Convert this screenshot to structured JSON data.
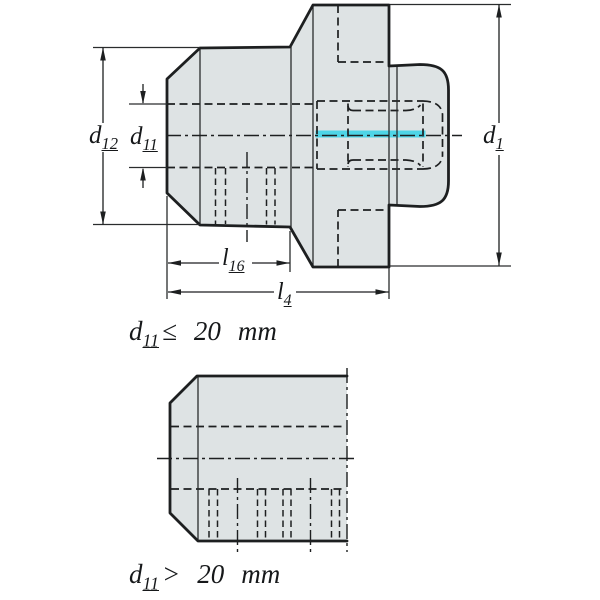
{
  "figure1": {
    "name": "adapter-section-small-bore",
    "labels": {
      "d12": {
        "base": "d",
        "sub": "12"
      },
      "d11": {
        "base": "d",
        "sub": "11"
      },
      "d1": {
        "base": "d",
        "sub": "1"
      },
      "l16": {
        "base": "l",
        "sub": "16"
      },
      "l4": {
        "base": "l",
        "sub": "4"
      }
    },
    "caption": {
      "base": "d",
      "sub": "11",
      "operator": "≤",
      "value": "20",
      "unit": "mm"
    }
  },
  "figure2": {
    "name": "adapter-section-large-bore",
    "caption": {
      "base": "d",
      "sub": "11",
      "operator": ">",
      "value": "20",
      "unit": "mm"
    }
  },
  "colors": {
    "part_fill": "#dee3e4",
    "line": "#1d1f20",
    "highlight": "#4ed5e7",
    "background": "#ffffff"
  }
}
